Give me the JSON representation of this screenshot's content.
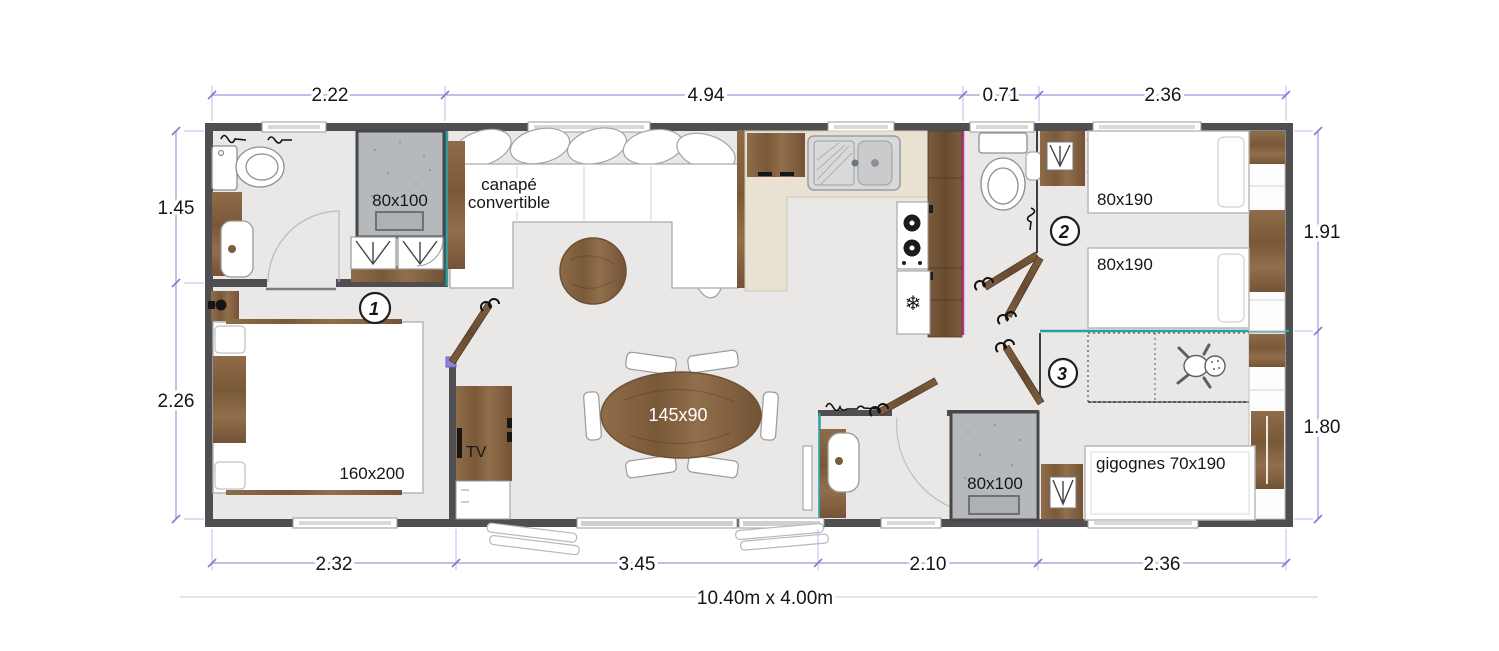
{
  "plan": {
    "overall_size": "10.40m x 4.00m",
    "dims_top": [
      "2.22",
      "4.94",
      "0.71",
      "2.36"
    ],
    "dims_left": [
      "1.45",
      "2.26"
    ],
    "dims_right": [
      "1.91",
      "1.80"
    ],
    "dims_bottom": [
      "2.32",
      "3.45",
      "2.10",
      "2.36"
    ],
    "rooms": {
      "bedroom_1": {
        "number": "1",
        "bed_label": "160x200",
        "tv_label": "TV"
      },
      "living": {
        "sofa_label_line1": "canapé",
        "sofa_label_line2": "convertible"
      },
      "shower_room_1": {
        "shower_label": "80x100"
      },
      "bedroom_2": {
        "number": "2",
        "bed_top_label": "80x190",
        "bed_bottom_label": "80x190"
      },
      "bedroom_3": {
        "number": "3",
        "bed_label": "gigognes 70x190"
      },
      "shower_room_2": {
        "shower_label": "80x100"
      },
      "dining": {
        "table_label": "145x90"
      }
    },
    "icons": {
      "fridge_glyph": "❄"
    }
  },
  "colors": {
    "wall": "#4f4f51",
    "floor": "#e9e8e6",
    "counter": "#e9e1d2",
    "shower": "#b6b9bb",
    "teal": "#2d9fa0",
    "magenta": "#c2319c",
    "dimension": "#a595dc",
    "hinge": "#8d85d6"
  }
}
